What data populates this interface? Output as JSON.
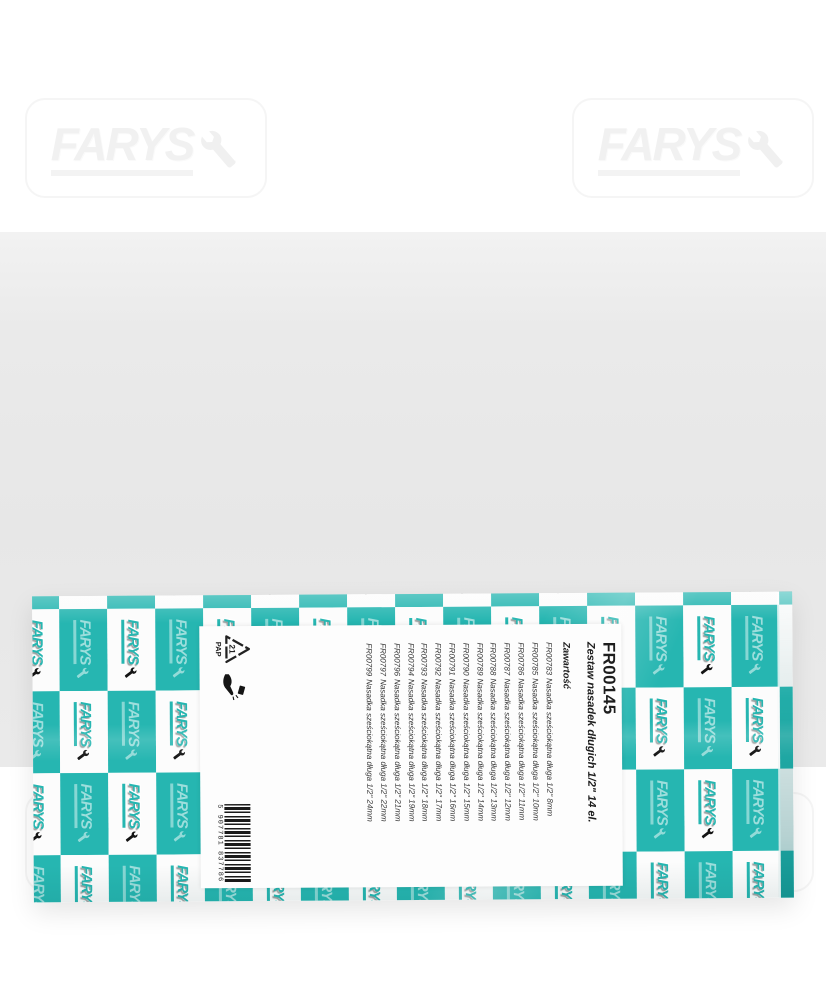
{
  "brand": {
    "name": "FARYS"
  },
  "colors": {
    "teal": "#26b6b1",
    "background_grey": "#e7e7e7",
    "label_white": "#fdfdfd"
  },
  "label": {
    "product_code": "FR00145",
    "product_name": "Zestaw nasadek długich 1/2\" 14 el.",
    "contents_heading": "Zawartość",
    "items": [
      {
        "code": "FR00783",
        "name": "Nasadka sześciokątna długa 1/2\" 8mm"
      },
      {
        "code": "FR00785",
        "name": "Nasadka sześciokątna długa 1/2\" 10mm"
      },
      {
        "code": "FR00786",
        "name": "Nasadka sześciokątna długa 1/2\" 11mm"
      },
      {
        "code": "FR00787",
        "name": "Nasadka sześciokątna długa 1/2\" 12mm"
      },
      {
        "code": "FR00788",
        "name": "Nasadka sześciokątna długa 1/2\" 13mm"
      },
      {
        "code": "FR00789",
        "name": "Nasadka sześciokątna długa 1/2\" 14mm"
      },
      {
        "code": "FR00790",
        "name": "Nasadka sześciokątna długa 1/2\" 15mm"
      },
      {
        "code": "FR00791",
        "name": "Nasadka sześciokątna długa 1/2\" 16mm"
      },
      {
        "code": "FR00792",
        "name": "Nasadka sześciokątna długa 1/2\" 17mm"
      },
      {
        "code": "FR00793",
        "name": "Nasadka sześciokątna długa 1/2\" 18mm"
      },
      {
        "code": "FR00794",
        "name": "Nasadka sześciokątna długa 1/2\" 19mm"
      },
      {
        "code": "FR00796",
        "name": "Nasadka sześciokątna długa 1/2\" 21mm"
      },
      {
        "code": "FR00797",
        "name": "Nasadka sześciokątna długa 1/2\" 22mm"
      },
      {
        "code": "FR00799",
        "name": "Nasadka sześciokątna długa 1/2\" 24mm"
      }
    ],
    "recycling": {
      "code": "21",
      "material": "PAP"
    },
    "barcode_number": "5 907781 837786"
  }
}
